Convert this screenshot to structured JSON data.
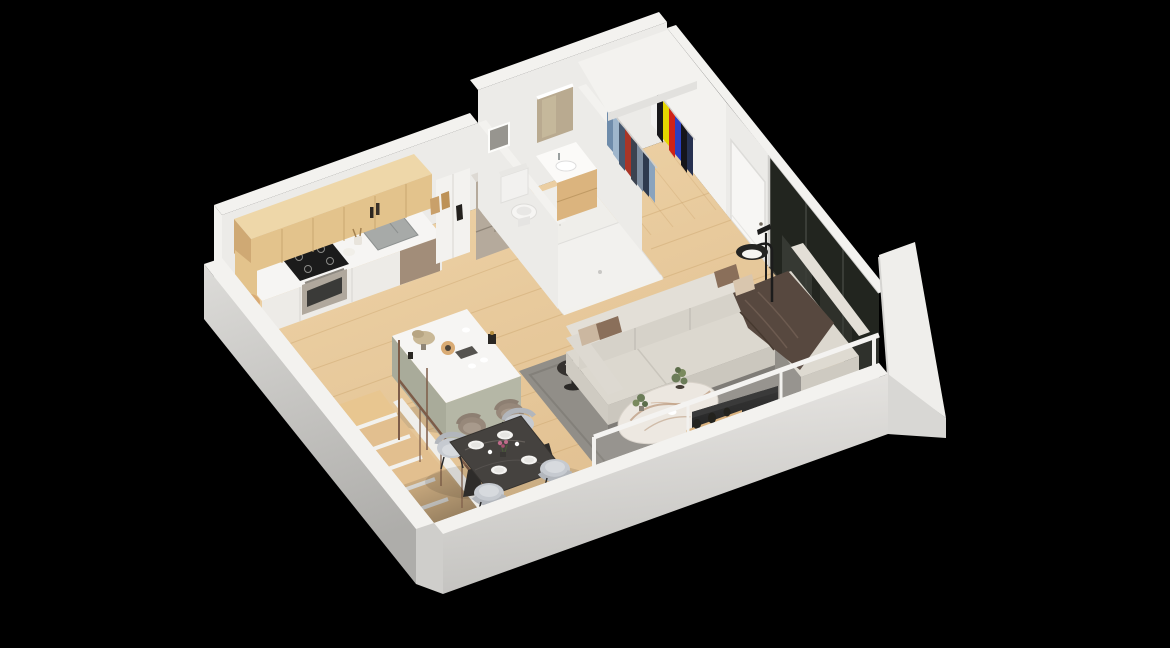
{
  "scene": {
    "title": "3D isometric studio apartment floor plan render",
    "style": "axonometric architectural rendering on black background",
    "rooms": [
      {
        "name": "kitchen",
        "items": [
          "wood upper cabinets",
          "white counter run",
          "gas cooktop",
          "stainless oven",
          "double sink with faucet",
          "dishwasher panel",
          "pantry cabinet",
          "stainless refrigerator",
          "cutting board",
          "utensil crock",
          "bottles",
          "paper bags"
        ]
      },
      {
        "name": "bathroom",
        "items": [
          "toilet",
          "wood vanity with white basin",
          "lit mirror",
          "walk-in shower tray",
          "recessed window",
          "speckled tile floor"
        ]
      },
      {
        "name": "closet",
        "items": [
          "white canopy shelf",
          "hanging rod with denim clothes",
          "hanging rod with colorful clothes"
        ]
      },
      {
        "name": "entry-hall",
        "items": [
          "white entry door",
          "floor-to-ceiling dark glass panels",
          "thin floor lamp"
        ]
      },
      {
        "name": "living-room",
        "items": [
          "L-shaped light gray sectional sofa",
          "throw blanket",
          "accent pillows",
          "oval marble coffee table",
          "black round side table with book",
          "arc reading lamp",
          "gray area rug",
          "flat screen TV",
          "low wood media console",
          "wood shelf with black vases",
          "white framed glass partition",
          "potted plant"
        ]
      },
      {
        "name": "dining-area",
        "items": [
          "dark marble dining table",
          "four gray upholstered chairs",
          "place settings",
          "flower centerpiece"
        ]
      },
      {
        "name": "kitchen-island",
        "items": [
          "white waterfall countertop",
          "sage base",
          "two taupe bar stools",
          "dried flowers",
          "serving board",
          "coffee cups"
        ]
      },
      {
        "name": "staircase",
        "items": [
          "wood treads",
          "white stringer",
          "bronze railing with balusters"
        ]
      }
    ]
  },
  "closet": {
    "rack_side_colors": [
      "#6f8cab",
      "#9fb6cc",
      "#46586f",
      "#a93527",
      "#3c4350",
      "#7d8da0",
      "#2e3a4e",
      "#8aa3bd"
    ],
    "rack_front_colors": [
      "#f2f2f2",
      "#17171a",
      "#e5d600",
      "#cf2217",
      "#2b3fc0",
      "#15151a",
      "#263150"
    ]
  },
  "palette": {
    "bg": "#000000",
    "floorWood": "#ebcfa2",
    "floorWoodDeep": "#dcba8a",
    "plank": "#b98f54",
    "wallFace": "#ecebe8",
    "wallBright": "#f3f2ef",
    "wallDim": "#e3e2df",
    "wallOuter": "#d8d7d4",
    "wallShade": "#bfbebb",
    "cabinetWood": "#e3c38c",
    "cabinetWoodTop": "#eed7a9",
    "cabinetWoodDark": "#cfa974",
    "cabinetSeam": "#c8a76f",
    "counterTop": "#f6f5f3",
    "counterFace": "#edebe7",
    "applianceSteel": "#b5aa9c",
    "cooktop": "#1b1b1b",
    "dishwasherPanel": "#a28d79",
    "tile": "#efeeea",
    "sofa": "#dcd8cf",
    "sofaFront": "#cbc7be",
    "sofaBack": "#e3dfd7",
    "throw": "#57483f",
    "rug": "#918e88",
    "rugDark": "#7f7c76",
    "marble": "#ece7e0",
    "marbleVein": "#b08968",
    "diningTable": "#45423f",
    "chair": "#c6cad0",
    "chairInner": "#d7dade",
    "stool": "#97887a",
    "tv": "#131313",
    "woodConsole": "#d8ae77",
    "glass": "#22251f",
    "glassReflect": "#474a43",
    "railing": "#7d5c48",
    "sage": "#b5b7a6",
    "sageDark": "#a9ab9a",
    "mirror": "#b9aa90",
    "plant": "#6b7c58",
    "accentPink": "#c06a8a"
  }
}
